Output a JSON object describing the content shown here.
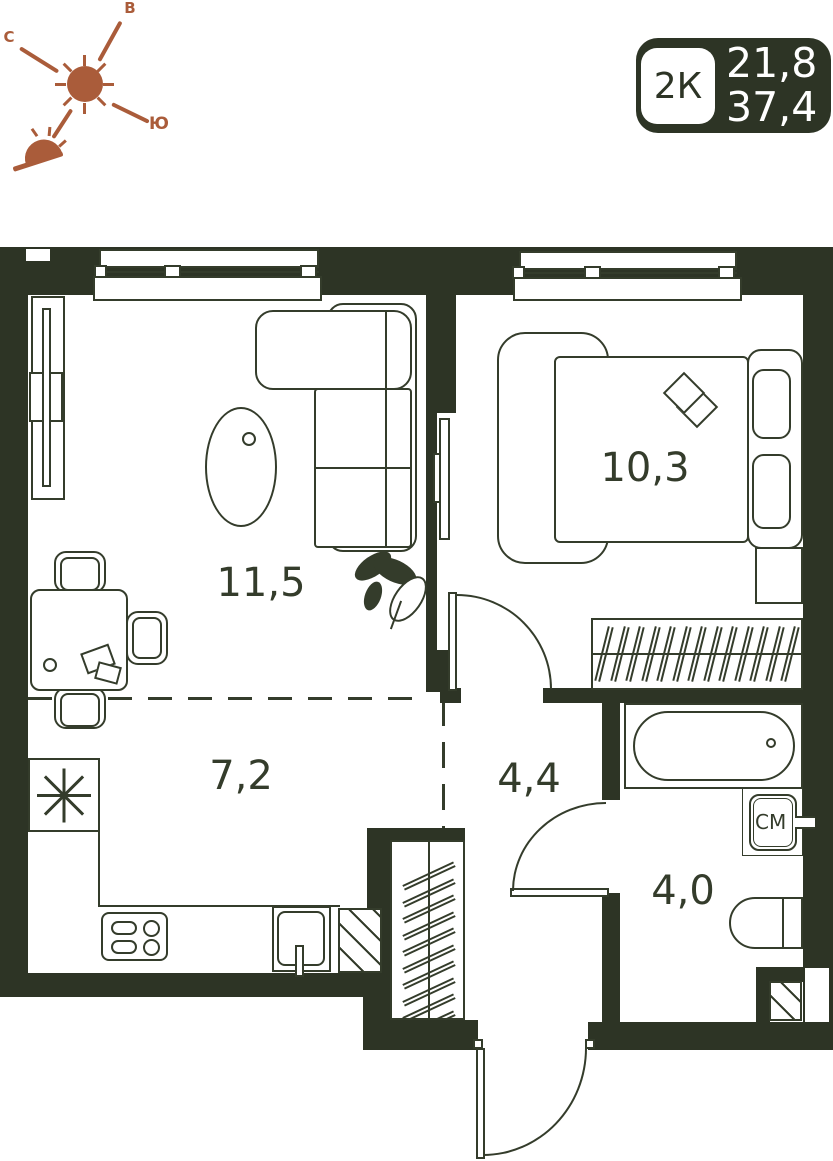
{
  "plan_card": {
    "type_badge": "2К",
    "living_area": "21,8",
    "total_area": "37,4"
  },
  "compass": {
    "north_label": "С",
    "east_label": "В",
    "south_label": "Ю"
  },
  "rooms": {
    "living_room": {
      "area_label": "11,5"
    },
    "bedroom": {
      "area_label": "10,3"
    },
    "kitchen": {
      "area_label": "7,2"
    },
    "hallway": {
      "area_label": "4,4"
    },
    "bathroom": {
      "area_label": "4,0"
    }
  },
  "appliances": {
    "washing_machine_label": "СМ"
  },
  "icons": [
    "sun-icon",
    "sunset-icon",
    "fridge-asterisk-icon"
  ],
  "colors": {
    "wall": "#2d3425",
    "ink": "#343c2b",
    "compass_accent": "#aa5c3a",
    "badge_bg": "#2d3425",
    "badge_text": "#ffffff"
  }
}
